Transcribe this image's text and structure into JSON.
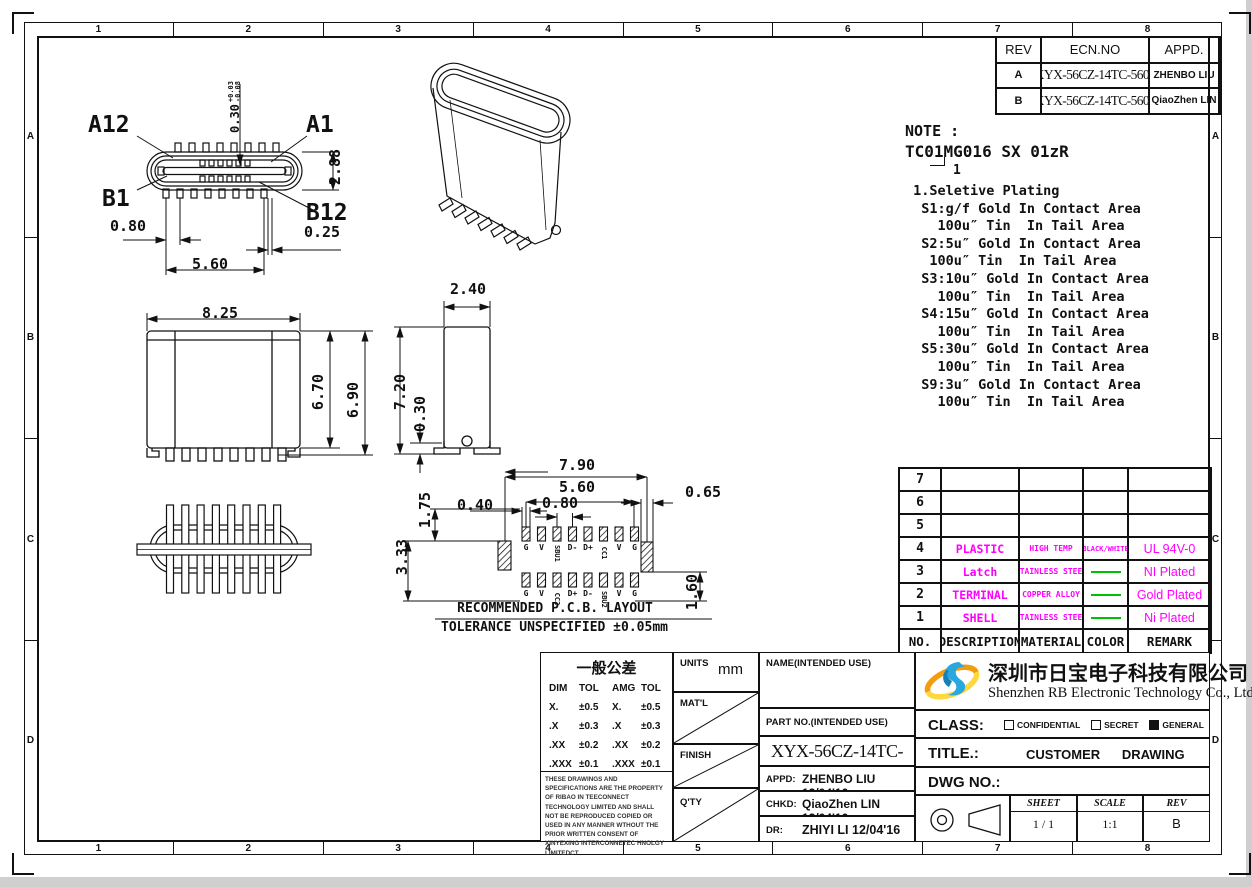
{
  "zones": {
    "cols": [
      "1",
      "2",
      "3",
      "4",
      "5",
      "6",
      "7",
      "8"
    ],
    "rows": [
      "A",
      "B",
      "C",
      "D"
    ]
  },
  "revision_table": {
    "headers": [
      "REV",
      "ECN.NO",
      "APPD."
    ],
    "rows": [
      [
        "A",
        "XYX-56CZ-14TC-5601",
        "ZHENBO LIU"
      ],
      [
        "B",
        "XYX-56CZ-14TC-5601",
        "QiaoZhen LIN"
      ]
    ]
  },
  "note": {
    "label": "NOTE :",
    "code": "TC01MG016 SX 01zR",
    "code_callout": "1",
    "lines": [
      " 1.Seletive Plating",
      "  S1:g/f Gold In Contact Area",
      "    100u″ Tin  In Tail Area",
      "  S2:5u″ Gold In Contact Area",
      "   100u″ Tin  In Tail Area",
      "  S3:10u″ Gold In Contact Area",
      "    100u″ Tin  In Tail Area",
      "  S4:15u″ Gold In Contact Area",
      "    100u″ Tin  In Tail Area",
      "  S5:30u″ Gold In Contact Area",
      "    100u″ Tin  In Tail Area",
      "  S9:3u″ Gold In Contact Area",
      "    100u″ Tin  In Tail Area"
    ]
  },
  "front_view": {
    "labels": {
      "a12": "A12",
      "a1": "A1",
      "b1": "B1",
      "b12": "B12"
    },
    "dims": {
      "tongue": "0.30",
      "tol_plus": "+0.03",
      "tol_minus": "-0.08",
      "height": "2.88",
      "pitch": "0.80",
      "gap": "0.25",
      "span": "5.60"
    }
  },
  "elevation_view": {
    "dims": {
      "width": "8.25",
      "height_inner": "6.70",
      "height_outer": "6.90"
    }
  },
  "side_view": {
    "dims": {
      "width": "2.40",
      "height": "7.20",
      "standoff": "0.30"
    }
  },
  "pcb_view": {
    "dims": {
      "outer_span": "7.90",
      "pad_span": "5.60",
      "pitch": "0.80",
      "pad_width": "0.40",
      "tab_width": "0.65",
      "row_offset": "1.75",
      "row_span": "3.33",
      "tab_height": "1.60"
    },
    "top_pins": [
      "G",
      "V",
      "SBU1",
      "D-",
      "D+",
      "CC1",
      "V",
      "G"
    ],
    "bottom_pins": [
      "G",
      "V",
      "CC2",
      "D+",
      "D-",
      "SBU2",
      "V",
      "G"
    ],
    "caption1": "RECOMMENDED  P.C.B. LAYOUT",
    "caption2": "TOLERANCE UNSPECIFIED ±0.05mm"
  },
  "bom_table": {
    "headers": [
      "NO.",
      "DESCRIPTION",
      "MATERIAL",
      "COLOR",
      "REMARK"
    ],
    "rows": [
      [
        "7",
        "",
        "",
        "",
        ""
      ],
      [
        "6",
        "",
        "",
        "",
        ""
      ],
      [
        "5",
        "",
        "",
        "",
        ""
      ],
      [
        "4",
        "PLASTIC",
        "HIGH TEMP",
        "BLACK/WHITE",
        "UL 94V-0"
      ],
      [
        "3",
        "Latch",
        "STAINLESS STEEL",
        "line",
        "NI Plated"
      ],
      [
        "2",
        "TERMINAL",
        "COPPER ALLOY",
        "line",
        "Gold Plated"
      ],
      [
        "1",
        "SHELL",
        "STAINLESS STEEL",
        "line",
        "Ni Plated"
      ]
    ],
    "accent_magenta": "#ff00ff",
    "accent_green": "#00c000"
  },
  "title_block": {
    "tolerance_title": "一般公差",
    "tolerance_headers": [
      "DIM",
      "TOL",
      "AMG",
      "TOL"
    ],
    "tolerance_rows": [
      [
        "X.",
        "±0.5",
        "X.",
        "±0.5"
      ],
      [
        ".X",
        "±0.3",
        ".X",
        "±0.3"
      ],
      [
        ".XX",
        "±0.2",
        ".XX",
        "±0.2"
      ],
      [
        ".XXX",
        "±0.1",
        ".XXX",
        "±0.1"
      ]
    ],
    "legal": "THESE DRAWINGS AND SPECIFICATIONS ARE THE PROPERTY OF RIBAO IN TEECONNECT TECHNOLOGY LIMITED AND SHALL NOT BE REPRODUCED COPIED OR USED IN ANY MANNER WTHOUT THE PRIOR  WRITTEN CONSENT OF XINYEXING INTERCONNETEC HNOLGY LIMITEDCT",
    "units_label": "UNITS",
    "units_value": "mm",
    "matl_label": "MAT'L",
    "finish_label": "FINISH",
    "qty_label": "Q'TY",
    "name_label": "NAME(INTENDED  USE)",
    "part_label": "PART  NO.(INTENDED  USE)",
    "part_value": "XYX-56CZ-14TC-5601",
    "appd_label": "APPD:",
    "appd_value": "ZHENBO LIU 12/04'16",
    "chkd_label": "CHKD:",
    "chkd_value": "QiaoZhen LIN 12/04'16",
    "dr_label": "DR:",
    "dr_value": "ZHIYI LI  12/04'16",
    "company_cn": "深圳市日宝电子科技有限公司",
    "company_en": "Shenzhen RB Electronic Technology Co., Ltd.",
    "class_label": "CLASS:",
    "class_options": [
      {
        "label": "CONFIDENTIAL",
        "checked": false
      },
      {
        "label": "SECRET",
        "checked": false
      },
      {
        "label": "GENERAL",
        "checked": true
      }
    ],
    "title_label": "TITLE.:",
    "title_value": "CUSTOMER      DRAWING",
    "dwg_label": "DWG NO.:",
    "sheet_label": "SHEET",
    "sheet_value": "1 / 1",
    "scale_label": "SCALE",
    "scale_value": "1:1",
    "rev_label": "REV",
    "rev_value": "B"
  }
}
